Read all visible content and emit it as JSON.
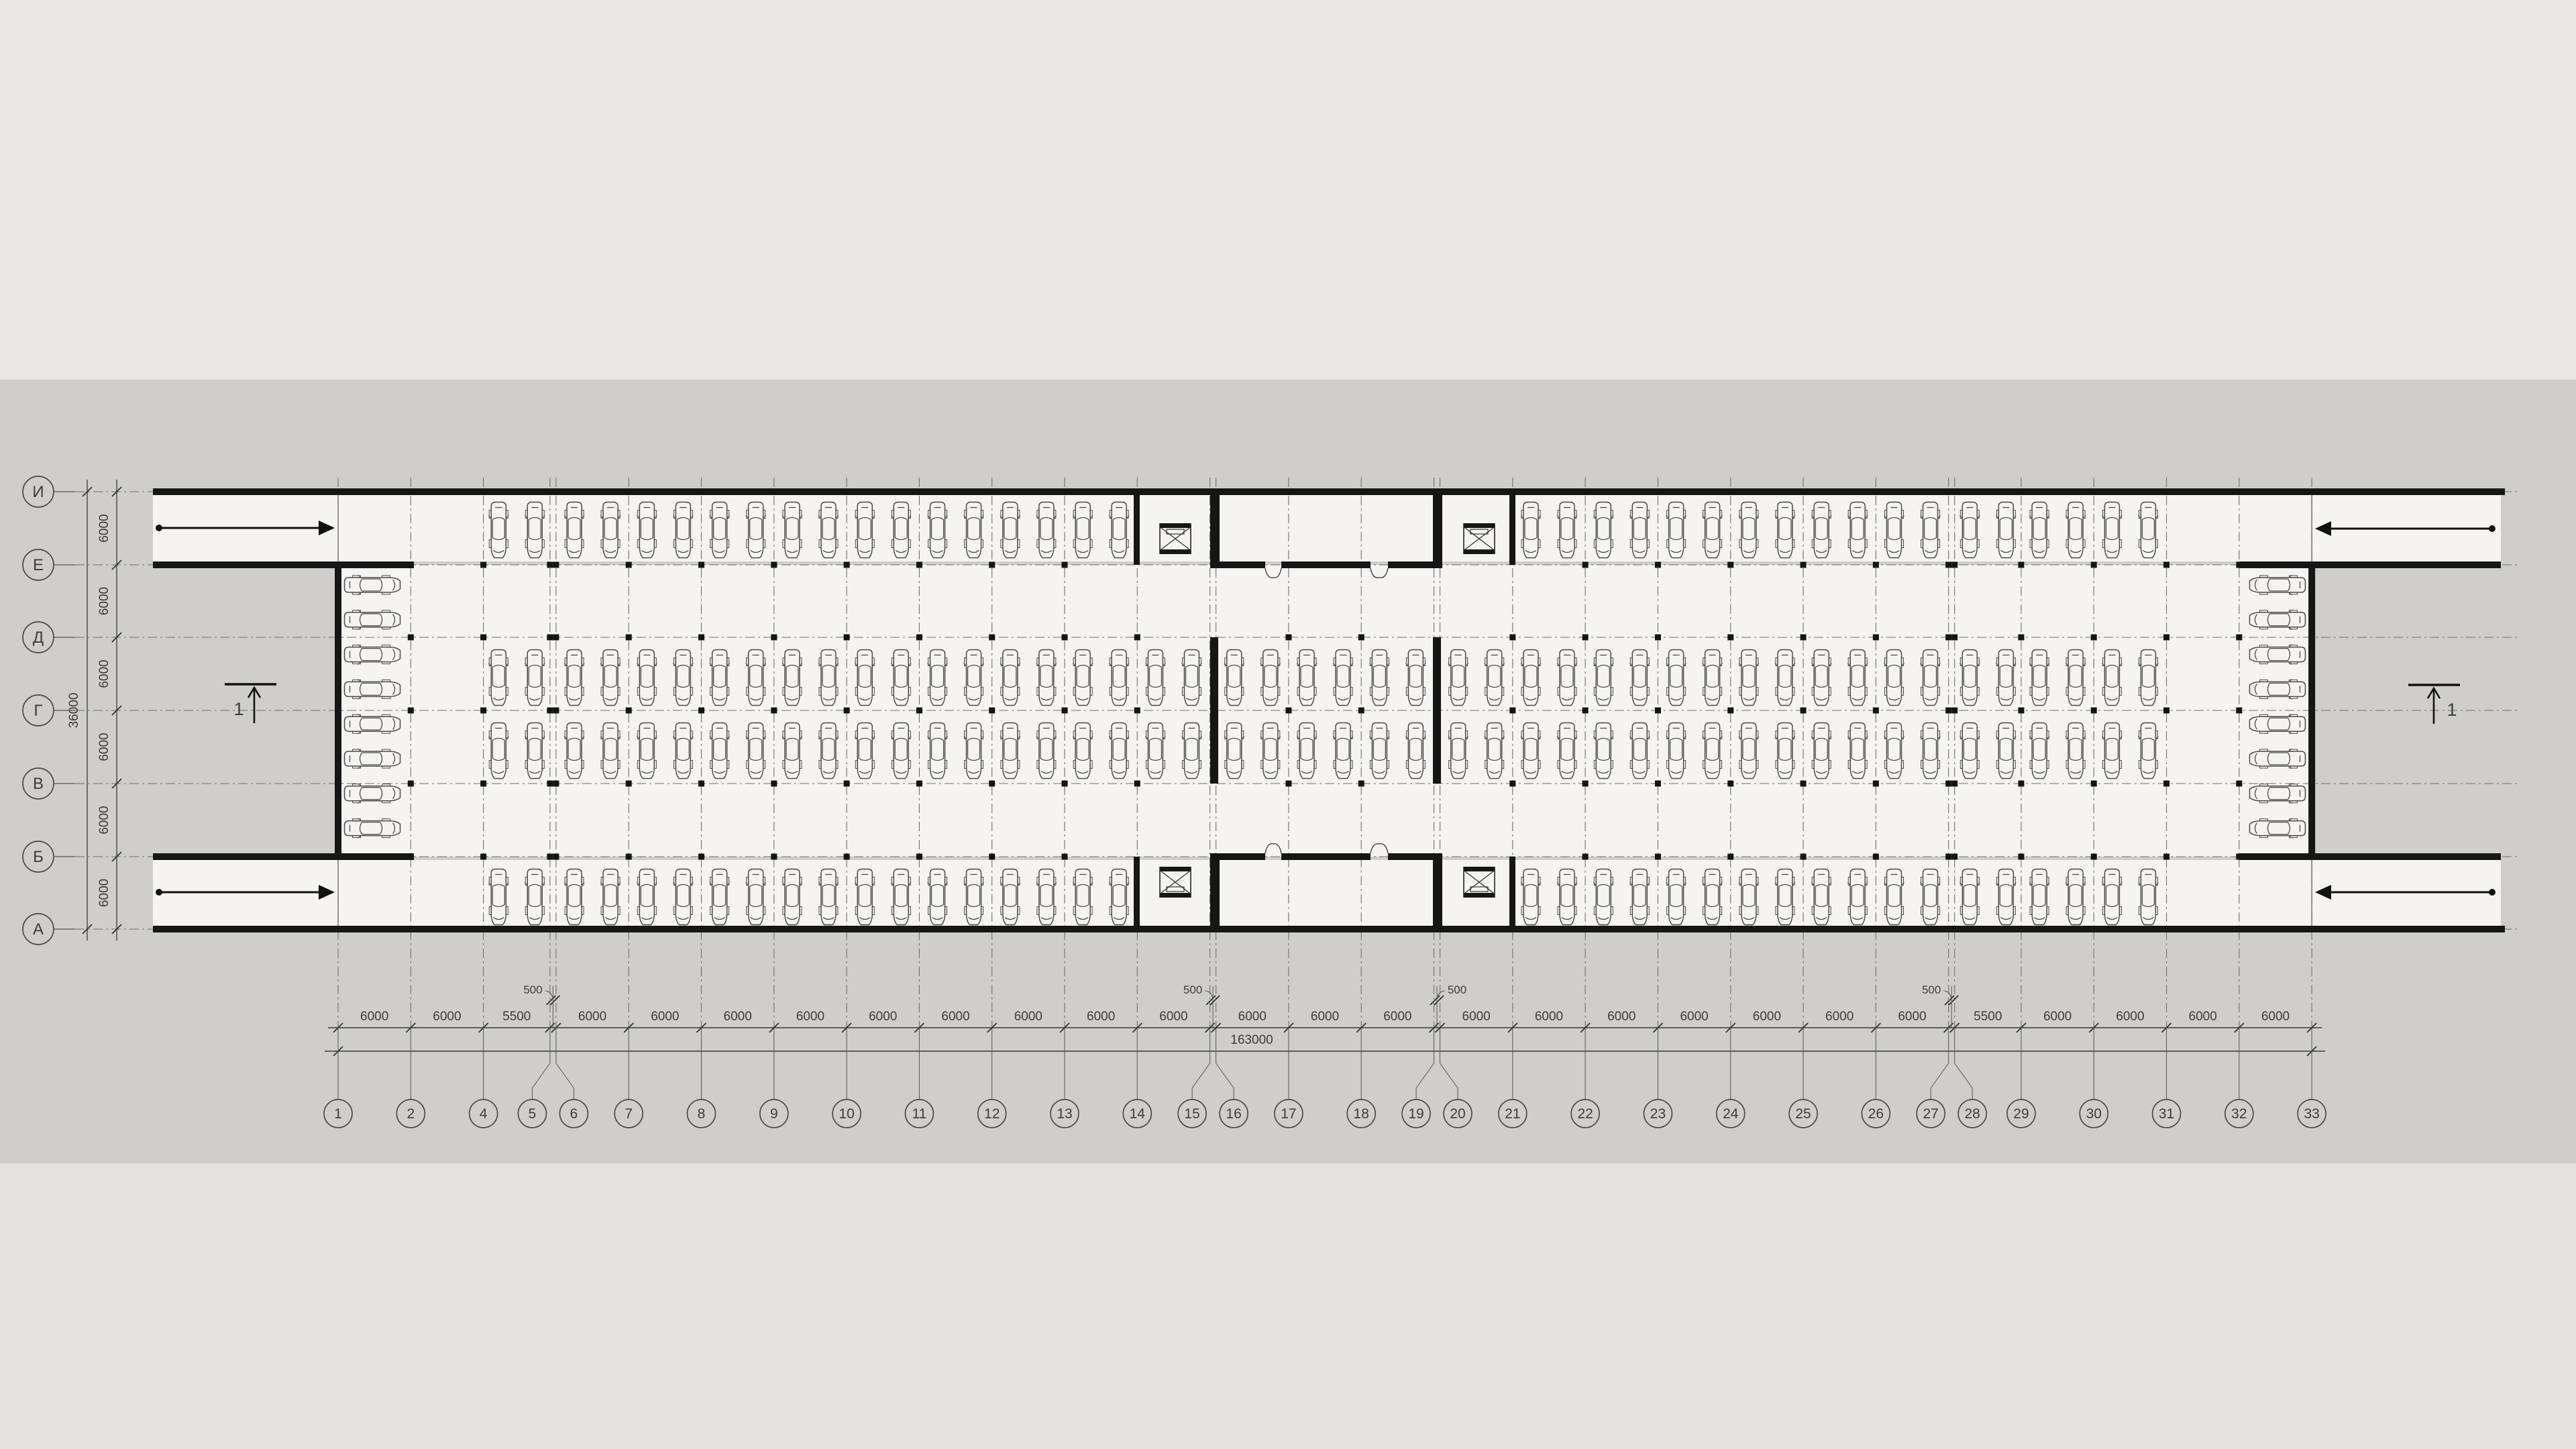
{
  "title": "План подземного паркинга  на отм. -4,500",
  "drawing_type": "underground parking floor plan",
  "axes": {
    "columns": {
      "labels": [
        "1",
        "2",
        "4",
        "5",
        "6",
        "7",
        "8",
        "9",
        "10",
        "11",
        "12",
        "13",
        "14",
        "15",
        "16",
        "17",
        "18",
        "19",
        "20",
        "21",
        "22",
        "23",
        "24",
        "25",
        "26",
        "27",
        "28",
        "29",
        "30",
        "31",
        "32",
        "33"
      ],
      "positions_mm": [
        0,
        6000,
        12000,
        17500,
        18000,
        24000,
        30000,
        36000,
        42000,
        48000,
        54000,
        60000,
        66000,
        72000,
        72500,
        78500,
        84500,
        90500,
        91000,
        97000,
        103000,
        109000,
        115000,
        121000,
        127000,
        133000,
        133500,
        139000,
        145000,
        151000,
        157000,
        163000
      ],
      "segment_labels": [
        "6000",
        "6000",
        "5500",
        null,
        "6000",
        "6000",
        "6000",
        "6000",
        "6000",
        "6000",
        "6000",
        "6000",
        "6000",
        null,
        "6000",
        "6000",
        "6000",
        null,
        "6000",
        "6000",
        "6000",
        "6000",
        "6000",
        "6000",
        "6000",
        null,
        "5500",
        "6000",
        "6000",
        "6000",
        "6000"
      ],
      "gap_callouts": [
        {
          "segment": 3,
          "label": "500",
          "side": "left"
        },
        {
          "segment": 13,
          "label": "500",
          "side": "left"
        },
        {
          "segment": 17,
          "label": "500",
          "side": "right"
        },
        {
          "segment": 25,
          "label": "500",
          "side": "left"
        }
      ],
      "total_label": "163000"
    },
    "rows": {
      "labels": [
        "И",
        "Е",
        "Д",
        "Г",
        "В",
        "Б",
        "А"
      ],
      "segment_labels": [
        "6000",
        "6000",
        "6000",
        "6000",
        "6000",
        "6000"
      ],
      "total_label": "36000"
    }
  },
  "section_marks": [
    {
      "label": "1",
      "side": "west"
    },
    {
      "label": "1",
      "side": "east"
    }
  ],
  "ramp_arrows": [
    {
      "location": "north-west",
      "direction": "east"
    },
    {
      "location": "south-west",
      "direction": "east"
    },
    {
      "location": "north-east",
      "direction": "west"
    },
    {
      "location": "south-east",
      "direction": "west"
    }
  ],
  "elevator_shafts": [
    {
      "strip": "north",
      "position": "west-of-core"
    },
    {
      "strip": "north",
      "position": "east-of-core"
    },
    {
      "strip": "south",
      "position": "west-of-core"
    },
    {
      "strip": "south",
      "position": "east-of-core"
    }
  ],
  "core_rooms": [
    {
      "strip": "north",
      "doors": 2
    },
    {
      "strip": "south",
      "doors": 2
    }
  ],
  "parking": {
    "cars_per_bay": 2,
    "perpendicular_rows": [
      {
        "name": "top-strip",
        "bays": [
          2,
          4,
          5,
          6,
          7,
          8,
          9,
          10,
          11,
          19,
          20,
          21,
          22,
          23,
          24,
          26,
          27,
          28
        ]
      },
      {
        "name": "middle-upper",
        "bays": [
          2,
          4,
          5,
          6,
          7,
          8,
          9,
          10,
          11,
          12,
          14,
          15,
          16,
          18,
          19,
          20,
          21,
          22,
          23,
          24,
          26,
          27,
          28
        ]
      },
      {
        "name": "middle-lower",
        "bays": [
          2,
          4,
          5,
          6,
          7,
          8,
          9,
          10,
          11,
          12,
          14,
          15,
          16,
          18,
          19,
          20,
          21,
          22,
          23,
          24,
          26,
          27,
          28
        ]
      },
      {
        "name": "bottom-strip",
        "bays": [
          2,
          4,
          5,
          6,
          7,
          8,
          9,
          10,
          11,
          19,
          20,
          21,
          22,
          23,
          24,
          26,
          27,
          28
        ]
      }
    ],
    "parallel_stacks": [
      {
        "name": "west-stack",
        "cars": 8,
        "nose": "east"
      },
      {
        "name": "east-stack",
        "cars": 8,
        "nose": "west"
      }
    ]
  },
  "colors": {
    "background_top": "#e9e7e3",
    "background_sheet": "#cfceca",
    "background_bottom": "#e4e3df",
    "floor": "#f5f4f1",
    "wall": "#161616",
    "line": "#555553",
    "grid": "#6e6e6c",
    "text": "#3c3c3a",
    "title_text": "#4e4d4b"
  }
}
